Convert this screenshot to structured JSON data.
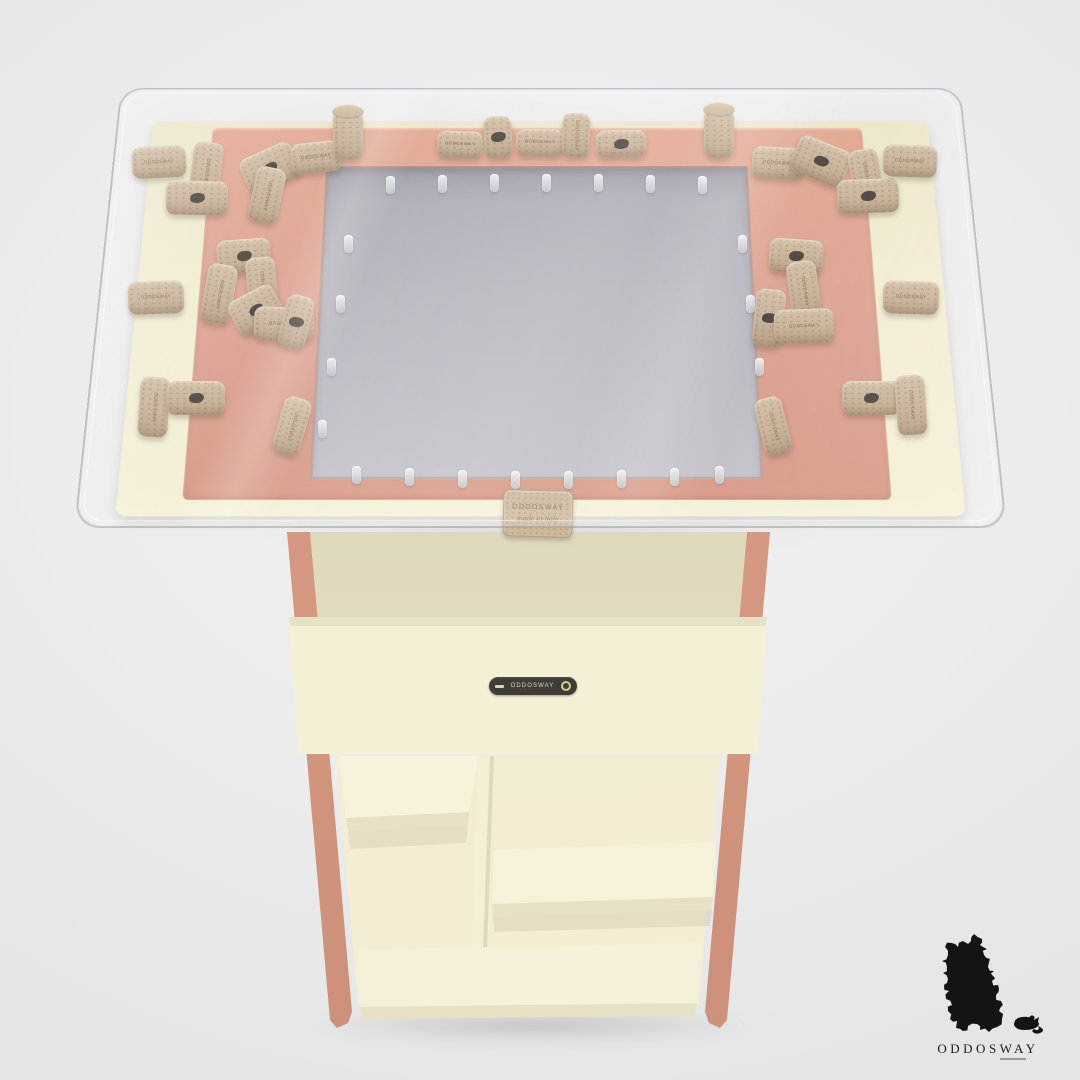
{
  "scene_title": "cork collector table product render",
  "colors": {
    "background": "#ececed",
    "salmon": "#dda191",
    "cream": "#f2edd2",
    "panel_gray": "#b7b6be",
    "cork": "#c9b29a",
    "stamp": "#3a3631",
    "badge_bg": "#403d38",
    "badge_text": "#ddd9bd",
    "logo_black": "#141414"
  },
  "badge": {
    "label": "ODDOSWAY"
  },
  "front_tag": {
    "line1": "ODDOSWAY",
    "line2": "made in italy"
  },
  "cork_label": "ODDOSWAY",
  "logo": {
    "brand": "ODDOSWAY",
    "island_icon": "sardinia-puzzle-silhouette",
    "mouse_icon": "mouse-silhouette"
  },
  "pegs": [
    {
      "x": 386,
      "y": 176
    },
    {
      "x": 438,
      "y": 175
    },
    {
      "x": 490,
      "y": 174
    },
    {
      "x": 542,
      "y": 174
    },
    {
      "x": 594,
      "y": 174
    },
    {
      "x": 646,
      "y": 175
    },
    {
      "x": 698,
      "y": 176
    },
    {
      "x": 352,
      "y": 466
    },
    {
      "x": 405,
      "y": 468
    },
    {
      "x": 458,
      "y": 470
    },
    {
      "x": 511,
      "y": 471
    },
    {
      "x": 564,
      "y": 471
    },
    {
      "x": 617,
      "y": 470
    },
    {
      "x": 670,
      "y": 468
    },
    {
      "x": 715,
      "y": 466
    },
    {
      "x": 344,
      "y": 235
    },
    {
      "x": 336,
      "y": 295
    },
    {
      "x": 327,
      "y": 358
    },
    {
      "x": 318,
      "y": 420
    },
    {
      "x": 738,
      "y": 235
    },
    {
      "x": 746,
      "y": 295
    },
    {
      "x": 755,
      "y": 358
    },
    {
      "x": 764,
      "y": 420
    }
  ],
  "corks": [
    {
      "x": 132,
      "y": 146,
      "w": 54,
      "h": 32,
      "r": -3,
      "kind": "h",
      "mark": "label"
    },
    {
      "x": 191,
      "y": 142,
      "w": 30,
      "h": 62,
      "r": 7,
      "kind": "v",
      "mark": "label"
    },
    {
      "x": 166,
      "y": 181,
      "w": 62,
      "h": 34,
      "r": 1,
      "kind": "h",
      "mark": "stamp"
    },
    {
      "x": 242,
      "y": 149,
      "w": 56,
      "h": 38,
      "r": -24,
      "kind": "h",
      "mark": "stamp"
    },
    {
      "x": 252,
      "y": 167,
      "w": 30,
      "h": 56,
      "r": 12,
      "kind": "v",
      "mark": "label"
    },
    {
      "x": 291,
      "y": 142,
      "w": 50,
      "h": 31,
      "r": -6,
      "kind": "h",
      "mark": "label"
    },
    {
      "x": 333,
      "y": 110,
      "w": 30,
      "h": 50,
      "r": 0,
      "kind": "standing",
      "mark": "none"
    },
    {
      "x": 437,
      "y": 131,
      "w": 46,
      "h": 27,
      "r": 2,
      "kind": "h",
      "mark": "label"
    },
    {
      "x": 484,
      "y": 116,
      "w": 28,
      "h": 42,
      "r": -3,
      "kind": "v",
      "mark": "stamp"
    },
    {
      "x": 516,
      "y": 129,
      "w": 48,
      "h": 27,
      "r": 1,
      "kind": "h",
      "mark": "label"
    },
    {
      "x": 562,
      "y": 113,
      "w": 28,
      "h": 44,
      "r": 2,
      "kind": "v",
      "mark": "label"
    },
    {
      "x": 596,
      "y": 130,
      "w": 50,
      "h": 27,
      "r": -1,
      "kind": "h",
      "mark": "stamp"
    },
    {
      "x": 704,
      "y": 108,
      "w": 30,
      "h": 50,
      "r": 0,
      "kind": "standing",
      "mark": "none"
    },
    {
      "x": 752,
      "y": 147,
      "w": 52,
      "h": 32,
      "r": 3,
      "kind": "h",
      "mark": "label"
    },
    {
      "x": 793,
      "y": 142,
      "w": 56,
      "h": 38,
      "r": 22,
      "kind": "h",
      "mark": "stamp"
    },
    {
      "x": 851,
      "y": 149,
      "w": 30,
      "h": 56,
      "r": -10,
      "kind": "v",
      "mark": "label"
    },
    {
      "x": 837,
      "y": 179,
      "w": 62,
      "h": 34,
      "r": -2,
      "kind": "h",
      "mark": "stamp"
    },
    {
      "x": 883,
      "y": 145,
      "w": 54,
      "h": 32,
      "r": 2,
      "kind": "h",
      "mark": "label"
    },
    {
      "x": 128,
      "y": 281,
      "w": 56,
      "h": 33,
      "r": -2,
      "kind": "h",
      "mark": "label"
    },
    {
      "x": 217,
      "y": 239,
      "w": 54,
      "h": 34,
      "r": -4,
      "kind": "h",
      "mark": "stamp"
    },
    {
      "x": 204,
      "y": 264,
      "w": 30,
      "h": 60,
      "r": 10,
      "kind": "v",
      "mark": "label"
    },
    {
      "x": 247,
      "y": 257,
      "w": 30,
      "h": 58,
      "r": -5,
      "kind": "v",
      "mark": "label"
    },
    {
      "x": 231,
      "y": 291,
      "w": 50,
      "h": 38,
      "r": -28,
      "kind": "h",
      "mark": "stamp"
    },
    {
      "x": 254,
      "y": 307,
      "w": 60,
      "h": 34,
      "r": 2,
      "kind": "h",
      "mark": "label"
    },
    {
      "x": 282,
      "y": 295,
      "w": 28,
      "h": 54,
      "r": 14,
      "kind": "v",
      "mark": "stamp"
    },
    {
      "x": 139,
      "y": 377,
      "w": 30,
      "h": 60,
      "r": 4,
      "kind": "v",
      "mark": "label"
    },
    {
      "x": 167,
      "y": 381,
      "w": 58,
      "h": 34,
      "r": 0,
      "kind": "h",
      "mark": "stamp"
    },
    {
      "x": 278,
      "y": 397,
      "w": 28,
      "h": 58,
      "r": 16,
      "kind": "v",
      "mark": "label"
    },
    {
      "x": 883,
      "y": 281,
      "w": 56,
      "h": 33,
      "r": 2,
      "kind": "h",
      "mark": "label"
    },
    {
      "x": 769,
      "y": 239,
      "w": 54,
      "h": 34,
      "r": 4,
      "kind": "h",
      "mark": "stamp"
    },
    {
      "x": 789,
      "y": 261,
      "w": 30,
      "h": 60,
      "r": -8,
      "kind": "v",
      "mark": "label"
    },
    {
      "x": 754,
      "y": 289,
      "w": 30,
      "h": 58,
      "r": 6,
      "kind": "v",
      "mark": "stamp"
    },
    {
      "x": 774,
      "y": 309,
      "w": 60,
      "h": 34,
      "r": -2,
      "kind": "h",
      "mark": "label"
    },
    {
      "x": 842,
      "y": 381,
      "w": 58,
      "h": 34,
      "r": 0,
      "kind": "h",
      "mark": "stamp"
    },
    {
      "x": 896,
      "y": 375,
      "w": 30,
      "h": 60,
      "r": -4,
      "kind": "v",
      "mark": "label"
    },
    {
      "x": 759,
      "y": 397,
      "w": 28,
      "h": 58,
      "r": -14,
      "kind": "v",
      "mark": "label"
    }
  ]
}
